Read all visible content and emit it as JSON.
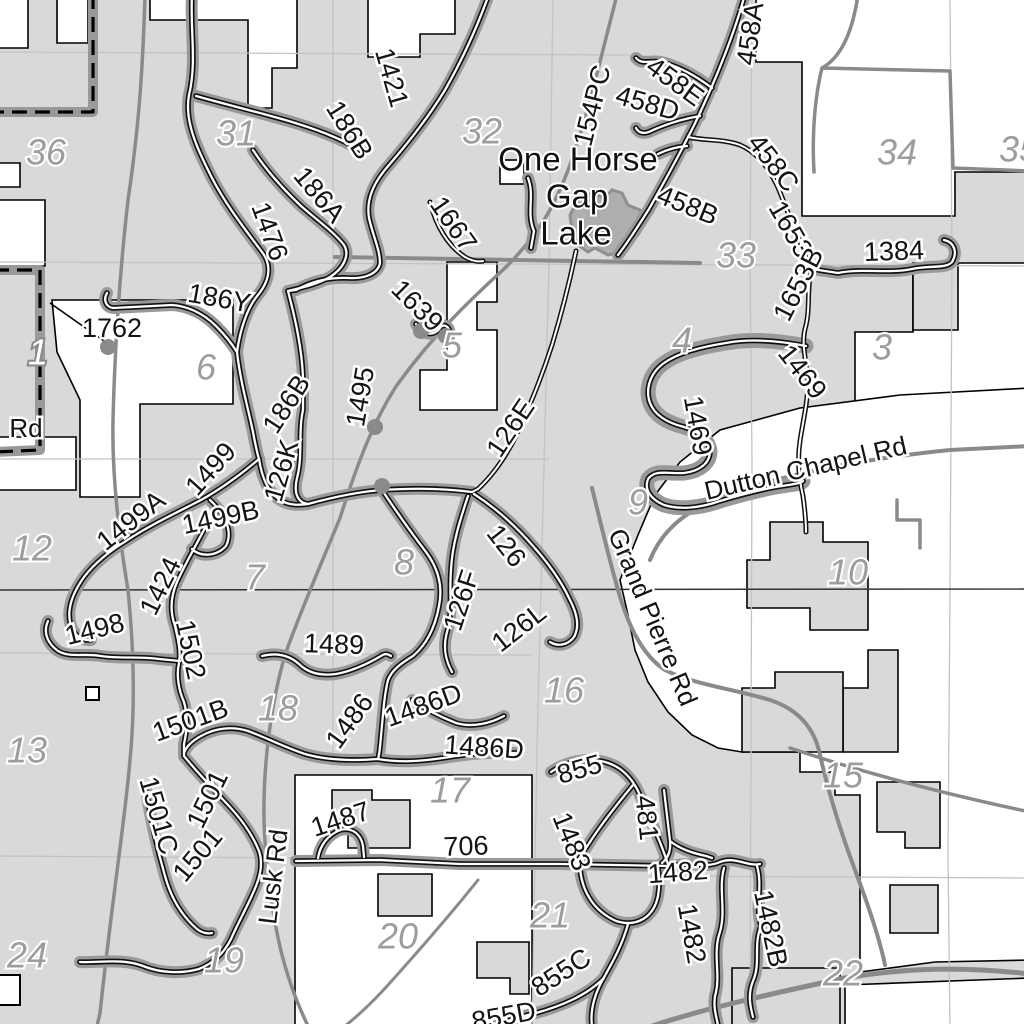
{
  "map": {
    "place_name": "One Horse Gap Lake",
    "colors": {
      "forest_fill": "#d9d9d9",
      "private_fill": "#ffffff",
      "lake_fill": "#aeaeae",
      "road_gray": "#8a8a8a",
      "trail_halo": "#999999",
      "trail_casing": "#111111",
      "trail_core": "#ffffff",
      "grid_line": "#c3c3c3",
      "township_line": "#333333"
    },
    "labels": [
      {
        "t": "1421",
        "x": 390,
        "y": 78,
        "r": 74,
        "c": "lt"
      },
      {
        "t": "186B",
        "x": 348,
        "y": 131,
        "r": 58,
        "c": "lt"
      },
      {
        "t": "186A",
        "x": 318,
        "y": 196,
        "r": 50,
        "c": "lt"
      },
      {
        "t": "1476",
        "x": 268,
        "y": 232,
        "r": 70,
        "c": "lt"
      },
      {
        "t": "154PC",
        "x": 594,
        "y": 106,
        "r": -76,
        "c": "lt"
      },
      {
        "t": "458A",
        "x": 752,
        "y": 34,
        "r": -82,
        "c": "lt"
      },
      {
        "t": "458E",
        "x": 674,
        "y": 83,
        "r": 36,
        "c": "lt"
      },
      {
        "t": "458D",
        "x": 647,
        "y": 105,
        "r": 16,
        "c": "lt"
      },
      {
        "t": "458C",
        "x": 772,
        "y": 164,
        "r": 52,
        "c": "lt"
      },
      {
        "t": "458B",
        "x": 687,
        "y": 207,
        "r": 22,
        "c": "lt"
      },
      {
        "t": "1653",
        "x": 789,
        "y": 230,
        "r": 60,
        "c": "lt"
      },
      {
        "t": "1653B",
        "x": 800,
        "y": 285,
        "r": -63,
        "c": "lt"
      },
      {
        "t": "1384",
        "x": 894,
        "y": 253,
        "r": -2,
        "c": "lt"
      },
      {
        "t": "1667",
        "x": 452,
        "y": 225,
        "r": 55,
        "c": "lt"
      },
      {
        "t": "1639",
        "x": 416,
        "y": 307,
        "r": 45,
        "c": "lt"
      },
      {
        "t": "186Y",
        "x": 219,
        "y": 300,
        "r": 10,
        "c": "lt"
      },
      {
        "t": "1762",
        "x": 112,
        "y": 330,
        "r": 0,
        "c": "lt"
      },
      {
        "t": "1495",
        "x": 362,
        "y": 397,
        "r": -80,
        "c": "lt"
      },
      {
        "t": "126E",
        "x": 512,
        "y": 429,
        "r": -56,
        "c": "lt"
      },
      {
        "t": "1469",
        "x": 801,
        "y": 373,
        "r": 52,
        "c": "lt"
      },
      {
        "t": "1469",
        "x": 696,
        "y": 426,
        "r": 80,
        "c": "lt"
      },
      {
        "t": "186B",
        "x": 288,
        "y": 405,
        "r": -57,
        "c": "lt"
      },
      {
        "t": "126K",
        "x": 283,
        "y": 471,
        "r": -74,
        "c": "lt"
      },
      {
        "t": "1499",
        "x": 212,
        "y": 470,
        "r": -48,
        "c": "lt"
      },
      {
        "t": "1499A",
        "x": 132,
        "y": 522,
        "r": -38,
        "c": "lt"
      },
      {
        "t": "1499B",
        "x": 221,
        "y": 519,
        "r": -12,
        "c": "lt"
      },
      {
        "t": "1424",
        "x": 162,
        "y": 587,
        "r": -64,
        "c": "lt"
      },
      {
        "t": "1498",
        "x": 95,
        "y": 631,
        "r": -14,
        "c": "lt"
      },
      {
        "t": "1502",
        "x": 189,
        "y": 650,
        "r": 78,
        "c": "lt"
      },
      {
        "t": "1489",
        "x": 334,
        "y": 646,
        "r": 2,
        "c": "lt"
      },
      {
        "t": "126",
        "x": 505,
        "y": 547,
        "r": 52,
        "c": "lt"
      },
      {
        "t": "126F",
        "x": 463,
        "y": 601,
        "r": -72,
        "c": "lt"
      },
      {
        "t": "126L",
        "x": 520,
        "y": 629,
        "r": -38,
        "c": "lt"
      },
      {
        "t": "1486",
        "x": 351,
        "y": 722,
        "r": -54,
        "c": "lt"
      },
      {
        "t": "1486D",
        "x": 424,
        "y": 707,
        "r": -20,
        "c": "lt"
      },
      {
        "t": "1486D",
        "x": 484,
        "y": 749,
        "r": 4,
        "c": "lt"
      },
      {
        "t": "1501B",
        "x": 191,
        "y": 722,
        "r": -20,
        "c": "lt"
      },
      {
        "t": "1501",
        "x": 209,
        "y": 800,
        "r": -64,
        "c": "lt"
      },
      {
        "t": "1501C",
        "x": 157,
        "y": 816,
        "r": 74,
        "c": "lt"
      },
      {
        "t": "1501",
        "x": 199,
        "y": 856,
        "r": -50,
        "c": "lt"
      },
      {
        "t": "1487",
        "x": 341,
        "y": 821,
        "r": -18,
        "c": "lt"
      },
      {
        "t": "706",
        "x": 466,
        "y": 848,
        "r": -2,
        "c": "lt"
      },
      {
        "t": "855",
        "x": 580,
        "y": 771,
        "r": -16,
        "c": "lt"
      },
      {
        "t": "1483",
        "x": 570,
        "y": 842,
        "r": 68,
        "c": "lt"
      },
      {
        "t": "481",
        "x": 645,
        "y": 818,
        "r": 84,
        "c": "lt"
      },
      {
        "t": "1482",
        "x": 678,
        "y": 874,
        "r": -4,
        "c": "lt"
      },
      {
        "t": "1482",
        "x": 690,
        "y": 934,
        "r": 80,
        "c": "lt"
      },
      {
        "t": "1482B",
        "x": 769,
        "y": 929,
        "r": 78,
        "c": "lt"
      },
      {
        "t": "855C",
        "x": 562,
        "y": 974,
        "r": -33,
        "c": "lt"
      },
      {
        "t": "855D",
        "x": 504,
        "y": 1018,
        "r": -10,
        "c": "lt"
      },
      {
        "t": "Dutton Chapel Rd",
        "x": 806,
        "y": 470,
        "r": -13,
        "c": "rd"
      },
      {
        "t": "Grand Pierre Rd",
        "x": 651,
        "y": 618,
        "r": 67,
        "c": "rd"
      },
      {
        "t": "Lusk Rd",
        "x": 275,
        "y": 877,
        "r": -83,
        "c": "rd"
      },
      {
        "t": "Rd",
        "x": 26,
        "y": 430,
        "r": 0,
        "c": "rd"
      },
      {
        "t": "One Horse",
        "x": 578,
        "y": 162,
        "r": 0,
        "c": "pl"
      },
      {
        "t": "Gap",
        "x": 577,
        "y": 199,
        "r": 0,
        "c": "pl"
      },
      {
        "t": "Lake",
        "x": 576,
        "y": 236,
        "r": 0,
        "c": "pl"
      },
      {
        "t": "36",
        "x": 46,
        "y": 155,
        "r": 0,
        "c": "sec"
      },
      {
        "t": "31",
        "x": 236,
        "y": 136,
        "r": 0,
        "c": "sec"
      },
      {
        "t": "32",
        "x": 482,
        "y": 134,
        "r": 0,
        "c": "sec"
      },
      {
        "t": "33",
        "x": 736,
        "y": 258,
        "r": 0,
        "c": "sec"
      },
      {
        "t": "34",
        "x": 897,
        "y": 155,
        "r": 0,
        "c": "sec"
      },
      {
        "t": "35",
        "x": 1019,
        "y": 152,
        "r": 0,
        "c": "sec"
      },
      {
        "t": "1",
        "x": 38,
        "y": 355,
        "r": 0,
        "c": "secd"
      },
      {
        "t": "6",
        "x": 206,
        "y": 370,
        "r": 0,
        "c": "sec"
      },
      {
        "t": "5",
        "x": 452,
        "y": 348,
        "r": 0,
        "c": "sec"
      },
      {
        "t": "4",
        "x": 682,
        "y": 343,
        "r": 0,
        "c": "sec"
      },
      {
        "t": "3",
        "x": 882,
        "y": 350,
        "r": 0,
        "c": "sec"
      },
      {
        "t": "12",
        "x": 32,
        "y": 551,
        "r": 0,
        "c": "sec"
      },
      {
        "t": "7",
        "x": 255,
        "y": 580,
        "r": 0,
        "c": "sec"
      },
      {
        "t": "8",
        "x": 404,
        "y": 565,
        "r": 0,
        "c": "sec"
      },
      {
        "t": "9",
        "x": 638,
        "y": 505,
        "r": 0,
        "c": "sec"
      },
      {
        "t": "10",
        "x": 848,
        "y": 575,
        "r": 0,
        "c": "sec"
      },
      {
        "t": "13",
        "x": 27,
        "y": 753,
        "r": 0,
        "c": "sec"
      },
      {
        "t": "18",
        "x": 278,
        "y": 711,
        "r": 0,
        "c": "sec"
      },
      {
        "t": "16",
        "x": 564,
        "y": 693,
        "r": 0,
        "c": "sec"
      },
      {
        "t": "17",
        "x": 450,
        "y": 793,
        "r": 0,
        "c": "sec"
      },
      {
        "t": "15",
        "x": 843,
        "y": 778,
        "r": 0,
        "c": "sec"
      },
      {
        "t": "24",
        "x": 27,
        "y": 958,
        "r": 0,
        "c": "sec"
      },
      {
        "t": "19",
        "x": 224,
        "y": 963,
        "r": 0,
        "c": "sec"
      },
      {
        "t": "20",
        "x": 398,
        "y": 939,
        "r": 0,
        "c": "sec"
      },
      {
        "t": "21",
        "x": 550,
        "y": 918,
        "r": 0,
        "c": "sec"
      },
      {
        "t": "22",
        "x": 843,
        "y": 976,
        "r": 0,
        "c": "sec"
      }
    ],
    "markers": [
      {
        "x": 108,
        "y": 347
      },
      {
        "x": 375,
        "y": 427
      },
      {
        "x": 382,
        "y": 486
      },
      {
        "x": 421,
        "y": 331
      },
      {
        "x": 446,
        "y": 336
      }
    ]
  }
}
